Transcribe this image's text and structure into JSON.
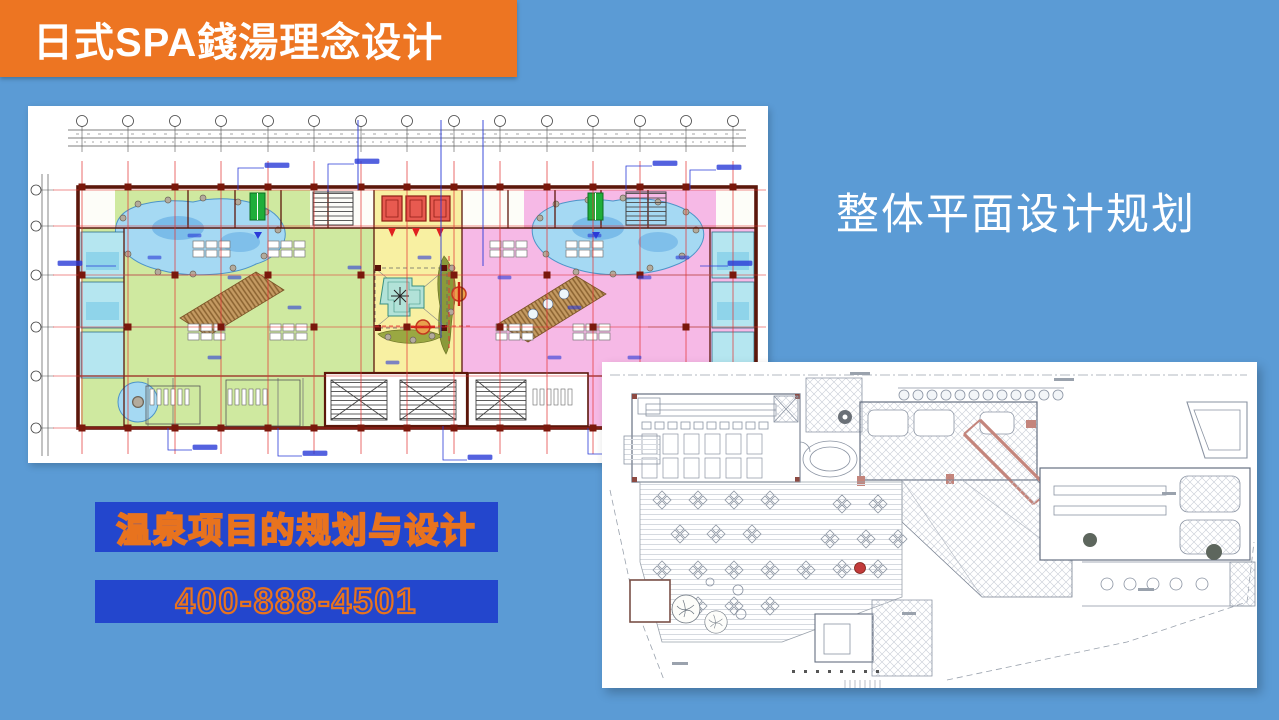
{
  "slide": {
    "background_color": "#5b9bd5"
  },
  "title_banner": {
    "text": "日式SPA錢湯理念设计",
    "background_color": "#ed7522",
    "text_color": "#ffffff"
  },
  "section_heading": {
    "text": "整体平面设计规划",
    "text_color": "#ffffff"
  },
  "promo": {
    "line1": "温泉项目的规划与设计",
    "phone": "400-888-4501",
    "background_color": "#2346cd",
    "outline_color": "#e8731e"
  },
  "figures": {
    "overall_plan_name": "overall-floor-plan",
    "detail_plan_name": "detail-floor-plan"
  }
}
